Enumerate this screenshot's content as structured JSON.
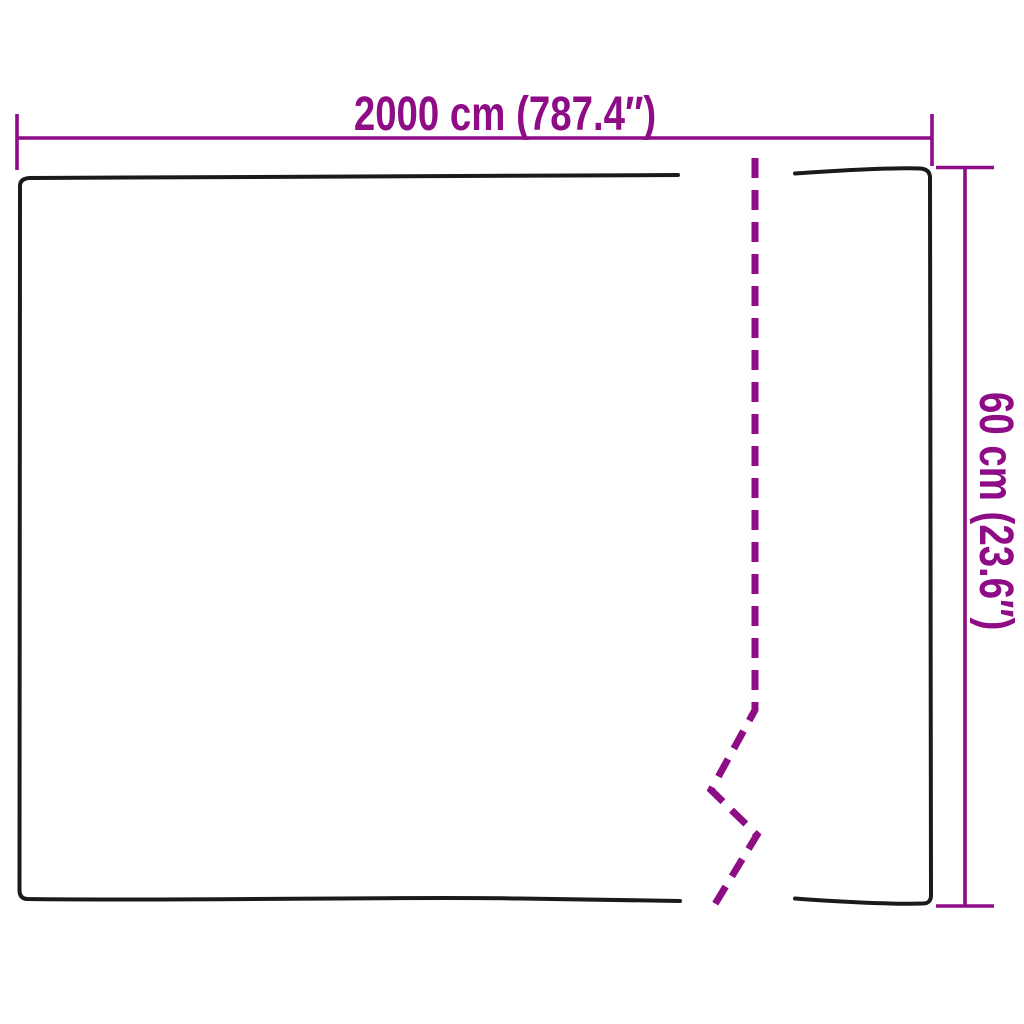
{
  "diagram": {
    "width_dimension": {
      "label": "2000 cm (787.4″)"
    },
    "height_dimension": {
      "label": "60 cm (23.6″)"
    },
    "colors": {
      "accent": "#8E0C86",
      "outline": "#1A1A1A",
      "background": "#FFFFFF"
    }
  }
}
